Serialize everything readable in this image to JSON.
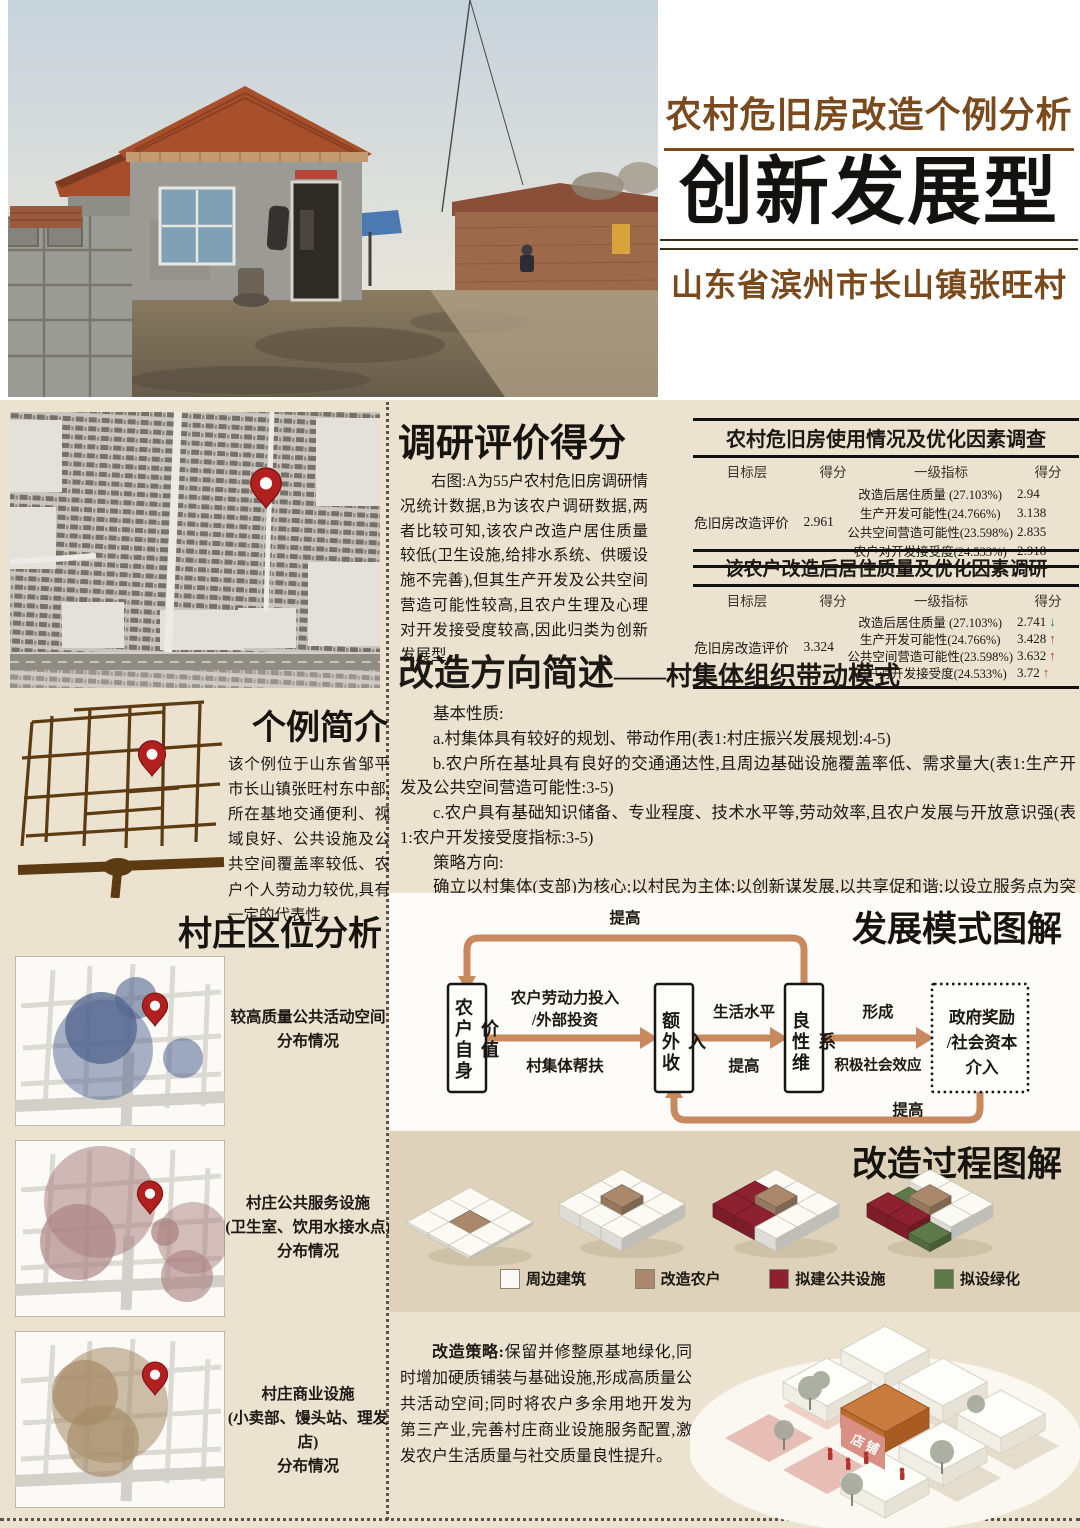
{
  "poster": {
    "kicker": "农村危旧房改造个例分析",
    "title": "创新发展型",
    "subtitle": "山东省滨州市长山镇张旺村"
  },
  "survey_section": {
    "heading": "调研评价得分",
    "body": "右图:A为55户农村危旧房调研情况统计数据,B为该农户调研数据,两者比较可知,该农户改造户居住质量较低(卫生设施,给排水系统、供暖设施不完善),但其生产开发及公共空间营造可能性较高,且农户生理及心理对开发接受度较高,因此归类为创新发展型。",
    "table_a": {
      "title": "农村危旧房使用情况及优化因素调查",
      "headers": [
        "目标层",
        "得分",
        "一级指标",
        "得分"
      ],
      "target": "危旧房改造评价",
      "target_score": "2.961",
      "rows": [
        {
          "indicator": "改造后居住质量 (27.103%)",
          "score": "2.94",
          "trend": ""
        },
        {
          "indicator": "生产开发可能性(24.766%)",
          "score": "3.138",
          "trend": ""
        },
        {
          "indicator": "公共空间营造可能性(23.598%)",
          "score": "2.835",
          "trend": ""
        },
        {
          "indicator": "农户对开发接受度(24.533%)",
          "score": "2.918",
          "trend": ""
        }
      ]
    },
    "table_b": {
      "title": "该农户改造后居住质量及优化因素调研",
      "headers": [
        "目标层",
        "得分",
        "一级指标",
        "得分"
      ],
      "target": "危旧房改造评价",
      "target_score": "3.324",
      "rows": [
        {
          "indicator": "改造后居住质量 (27.103%)",
          "score": "2.741",
          "trend": "↓"
        },
        {
          "indicator": "生产开发可能性(24.766%)",
          "score": "3.428",
          "trend": "↑"
        },
        {
          "indicator": "公共空间营造可能性(23.598%)",
          "score": "3.632",
          "trend": "↑"
        },
        {
          "indicator": "农户对开发接受度(24.533%)",
          "score": "3.72",
          "trend": "↑"
        }
      ]
    }
  },
  "direction_section": {
    "heading": "改造方向简述",
    "heading_suffix": "——村集体组织带动模式",
    "basic_label": "基本性质:",
    "items": [
      "a.村集体具有较好的规划、带动作用(表1:村庄振兴发展规划:4-5)",
      "b.农户所在基址具有良好的交通通达性,且周边基础设施覆盖率低、需求量大(表1:生产开发及公共空间营造可能性:3-5)",
      "c.农户具有基础知识储备、专业程度、技术水平等,劳动效率,且农户发展与开放意识强(表1:农户开发接受度指标:3-5)"
    ],
    "strategy_label": "策略方向:",
    "strategy": "确立以村集体(支部)为核心;以村民为主体;以创新谋发展,以共享促和谐;以设立服务点为突破口,打造农民创业平台;以组建合作社为切入点,实现三变;以三产带二产促一产,实现三产融合发展;调节收入分配,实现共同富裕;以此为基址,营造高质量公共空间,注重精神文明,淳厚乡风民俗。"
  },
  "case_intro": {
    "heading": "个例简介",
    "body": "该个例位于山东省邹平市长山镇张旺村东中部,所在基地交通便利、视域良好、公共设施及公共空间覆盖率较低、农户个人劳动力较优,具有一定的代表性。"
  },
  "location_analysis": {
    "heading": "村庄区位分析",
    "maps": [
      {
        "caption": "较高质量公共活动空间\n分布情况",
        "bubble_color": "#51648f"
      },
      {
        "caption": "村庄公共服务设施\n(卫生室、饮用水接水点)\n分布情况",
        "bubble_color": "#a97f7f"
      },
      {
        "caption": "村庄商业设施\n(小卖部、馒头站、理发店)\n分布情况",
        "bubble_color": "#a58a66"
      }
    ]
  },
  "development_model": {
    "heading": "发展模式图解",
    "boxes": [
      "农户自身价值",
      "额外收入",
      "良性维系",
      "政府奖励\n/社会资本\n介入"
    ],
    "labels": {
      "invest_line1": "农户劳动力投入",
      "invest_line2": "/外部投资",
      "invest_below": "村集体帮扶",
      "living_top": "生活水平",
      "living_bottom": "提高",
      "form_top": "形成",
      "form_bottom": "积极社会效应",
      "feedback_top": "提高",
      "feedback_bottom": "提高"
    },
    "arrow_color": "#c9895f"
  },
  "process_section": {
    "heading": "改造过程图解",
    "legend": [
      {
        "key": "w",
        "label": "周边建筑",
        "color": "#fbfaf4"
      },
      {
        "key": "t",
        "label": "改造农户",
        "color": "#a9886c"
      },
      {
        "key": "r",
        "label": "拟建公共设施",
        "color": "#8e2130"
      },
      {
        "key": "g",
        "label": "拟设绿化",
        "color": "#5e7a49"
      }
    ],
    "steps": [
      {
        "flat": true,
        "tiles": [
          "w",
          "w",
          "w",
          "w",
          "t",
          "w",
          "w",
          "w",
          "w"
        ]
      },
      {
        "flat": false,
        "tiles": [
          "w",
          "w",
          "w",
          "w",
          "t",
          "w",
          "w",
          "w",
          "w"
        ]
      },
      {
        "flat": false,
        "tiles": [
          "w",
          "w",
          "w",
          "r",
          "t",
          "w",
          "r",
          "r",
          "w"
        ]
      },
      {
        "flat": false,
        "tiles": [
          "w",
          "w",
          "w",
          "g",
          "t",
          "w",
          "r",
          "r",
          "g"
        ]
      }
    ]
  },
  "strategy_section": {
    "label": "改造策略:",
    "body": "保留并修整原基地绿化,同时增加硬质铺装与基础设施,形成高质量公共活动空间;同时将农户多余用地开发为第三产业,完善村庄商业设施服务配置,激发农户生活质量与社交质量良性提升。",
    "render_label": "店铺"
  },
  "colors": {
    "accent_brown": "#7a4a1c",
    "pin_red": "#b1201e",
    "paper": "#ebe2cf"
  }
}
